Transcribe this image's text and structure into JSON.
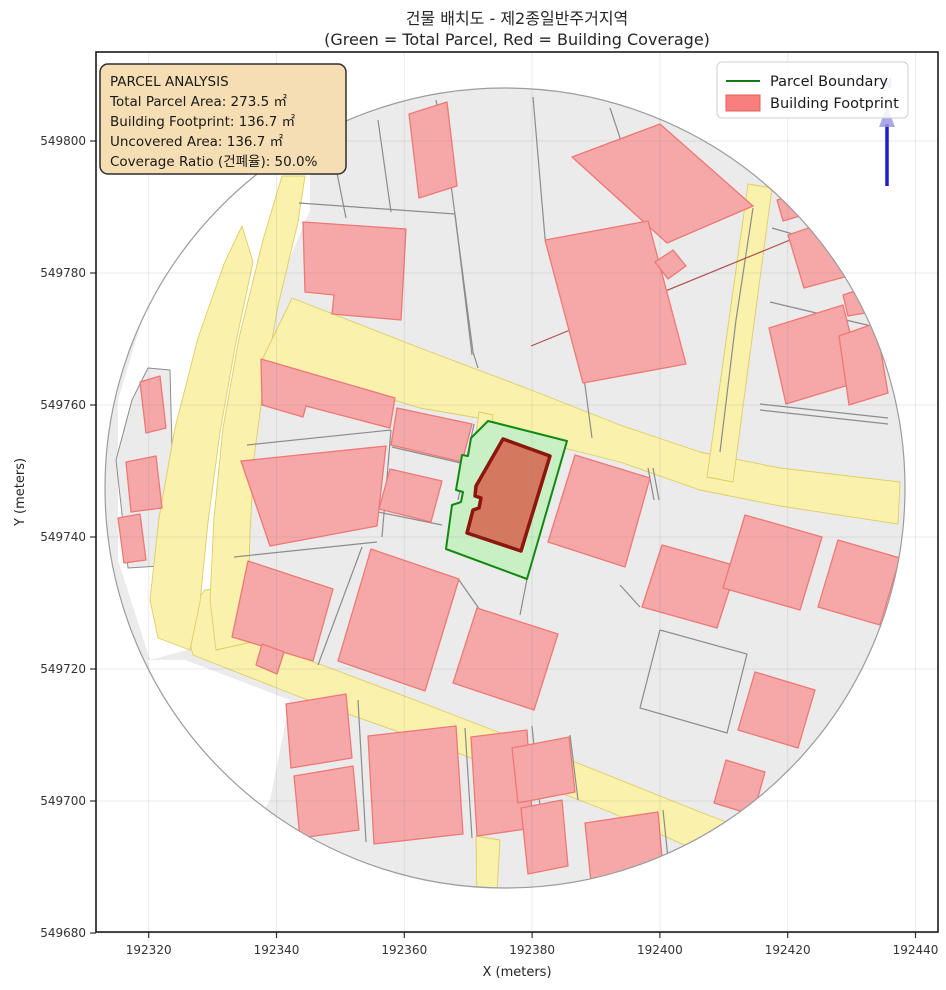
{
  "title": {
    "line1": "건물 배치도 - 제2종일반주거지역",
    "line2": "(Green = Total Parcel, Red = Building Coverage)"
  },
  "axes": {
    "xlabel": "X (meters)",
    "ylabel": "Y (meters)",
    "x_ticks": [
      192320,
      192340,
      192360,
      192380,
      192400,
      192420,
      192440
    ],
    "y_ticks": [
      549680,
      549700,
      549720,
      549740,
      549760,
      549780,
      549800
    ],
    "grid": true
  },
  "info_box": {
    "title": "PARCEL ANALYSIS",
    "line1": "Total Parcel Area: 273.5 ㎡",
    "line2": "Building Footprint: 136.7 ㎡",
    "line3": "Uncovered Area: 136.7 ㎡",
    "line4": "Coverage Ratio (건폐율): 50.0%"
  },
  "parcel_analysis": {
    "zoning": "제2종일반주거지역",
    "total_parcel_area_m2": 273.5,
    "building_footprint_m2": 136.7,
    "uncovered_area_m2": 136.7,
    "coverage_ratio_pct": 50.0
  },
  "legend": {
    "item1": "Parcel Boundary",
    "item2": "Building Footprint"
  },
  "north_arrow": {
    "label": "N"
  },
  "colors": {
    "figure_bg": "#ffffff",
    "block_gray": "#ebebeb",
    "road_fill": "#f9f1ac",
    "road_stroke": "#e0cd62",
    "building_fill": "#f5a8a7",
    "building_stroke": "#ee7876",
    "boundary_gray": "#8c8c8c",
    "circle_edge": "#9c9c9c",
    "parcel_green_fill": "#c9efc5",
    "parcel_green_stroke": "#128a12",
    "central_building_fill": "#d4795f",
    "central_building_stroke": "#8c150c",
    "infobox_fill": "#f5deb3",
    "infobox_stroke": "#2e2e2e",
    "legend_line": "#157a15",
    "legend_patch_fill": "#f97f7f",
    "legend_patch_stroke": "#e25c5a",
    "north_blue": "#1c1cd2",
    "north_lavender": "#9a9ae2",
    "grid_line": "rgba(128,128,128,0.16)",
    "red_boundary_line": "#b05050"
  },
  "map": {
    "clip_circle": {
      "cx": 505,
      "cy": 488,
      "r": 400
    },
    "white_patches": [
      [
        [
          210,
          170
        ],
        [
          310,
          170
        ],
        [
          310,
          210
        ],
        [
          260,
          330
        ],
        [
          235,
          430
        ],
        [
          220,
          530
        ],
        [
          205,
          645
        ],
        [
          150,
          660
        ],
        [
          118,
          560
        ],
        [
          118,
          400
        ],
        [
          160,
          260
        ]
      ],
      [
        [
          185,
          660
        ],
        [
          290,
          700
        ],
        [
          270,
          800
        ],
        [
          230,
          870
        ],
        [
          158,
          748
        ],
        [
          148,
          660
        ]
      ]
    ],
    "gray_patches": [
      [
        [
          148,
          368
        ],
        [
          170,
          370
        ],
        [
          175,
          565
        ],
        [
          128,
          568
        ],
        [
          116,
          460
        ],
        [
          132,
          400
        ]
      ]
    ],
    "roads": [
      [
        [
          246,
          586
        ],
        [
          254,
          640
        ],
        [
          330,
          668
        ],
        [
          420,
          702
        ],
        [
          560,
          756
        ],
        [
          700,
          812
        ],
        [
          800,
          850
        ],
        [
          786,
          890
        ],
        [
          610,
          812
        ],
        [
          450,
          750
        ],
        [
          300,
          697
        ],
        [
          193,
          655
        ],
        [
          183,
          618
        ],
        [
          205,
          590
        ]
      ],
      [
        [
          242,
          226
        ],
        [
          253,
          262
        ],
        [
          236,
          342
        ],
        [
          220,
          432
        ],
        [
          208,
          522
        ],
        [
          200,
          602
        ],
        [
          190,
          650
        ],
        [
          158,
          638
        ],
        [
          150,
          600
        ],
        [
          159,
          518
        ],
        [
          175,
          428
        ],
        [
          198,
          338
        ],
        [
          224,
          264
        ]
      ],
      [
        [
          282,
          176
        ],
        [
          305,
          176
        ],
        [
          298,
          222
        ],
        [
          278,
          306
        ],
        [
          263,
          390
        ],
        [
          254,
          458
        ],
        [
          250,
          534
        ],
        [
          248,
          600
        ],
        [
          252,
          642
        ],
        [
          216,
          650
        ],
        [
          210,
          600
        ],
        [
          214,
          518
        ],
        [
          223,
          428
        ],
        [
          239,
          338
        ],
        [
          263,
          240
        ]
      ],
      [
        [
          292,
          298
        ],
        [
          420,
          348
        ],
        [
          526,
          388
        ],
        [
          620,
          425
        ],
        [
          700,
          452
        ],
        [
          780,
          468
        ],
        [
          900,
          482
        ],
        [
          898,
          524
        ],
        [
          780,
          506
        ],
        [
          700,
          490
        ],
        [
          620,
          462
        ],
        [
          560,
          447
        ],
        [
          490,
          420
        ],
        [
          420,
          408
        ],
        [
          262,
          360
        ]
      ],
      [
        [
          748,
          184
        ],
        [
          772,
          188
        ],
        [
          733,
          482
        ],
        [
          707,
          477
        ]
      ],
      [
        [
          479,
          412
        ],
        [
          493,
          415
        ],
        [
          483,
          492
        ],
        [
          469,
          488
        ]
      ],
      [
        [
          476,
          836
        ],
        [
          500,
          840
        ],
        [
          496,
          908
        ],
        [
          477,
          903
        ]
      ]
    ],
    "boundary_lines": [
      [
        [
          332,
          148
        ],
        [
          346,
          218
        ]
      ],
      [
        [
          378,
          120
        ],
        [
          391,
          212
        ]
      ],
      [
        [
          436,
          100
        ],
        [
          452,
          192
        ],
        [
          473,
          352
        ],
        [
          478,
          368
        ]
      ],
      [
        [
          299,
          203
        ],
        [
          455,
          214
        ]
      ],
      [
        [
          455,
          214
        ],
        [
          472,
          355
        ]
      ],
      [
        [
          533,
          97
        ],
        [
          545,
          238
        ],
        [
          585,
          385
        ],
        [
          592,
          438
        ]
      ],
      [
        [
          753,
          208
        ],
        [
          736,
          320
        ],
        [
          720,
          452
        ]
      ],
      [
        [
          610,
          108
        ],
        [
          648,
          221
        ]
      ],
      [
        [
          772,
          228
        ],
        [
          890,
          262
        ]
      ],
      [
        [
          770,
          302
        ],
        [
          888,
          330
        ]
      ],
      [
        [
          760,
          404
        ],
        [
          888,
          418
        ]
      ],
      [
        [
          760,
          410
        ],
        [
          888,
          424
        ]
      ],
      [
        [
          247,
          445
        ],
        [
          391,
          430
        ]
      ],
      [
        [
          391,
          430
        ],
        [
          382,
          537
        ]
      ],
      [
        [
          234,
          557
        ],
        [
          377,
          542
        ]
      ],
      [
        [
          318,
          665
        ],
        [
          362,
          547
        ]
      ],
      [
        [
          459,
          580
        ],
        [
          480,
          610
        ]
      ],
      [
        [
          392,
          447
        ],
        [
          465,
          464
        ]
      ],
      [
        [
          378,
          512
        ],
        [
          442,
          525
        ]
      ],
      [
        [
          474,
          424
        ],
        [
          458,
          500
        ]
      ],
      [
        [
          660,
          630
        ],
        [
          747,
          654
        ],
        [
          727,
          733
        ],
        [
          640,
          708
        ],
        [
          660,
          630
        ]
      ],
      [
        [
          358,
          700
        ],
        [
          366,
          842
        ]
      ],
      [
        [
          465,
          728
        ],
        [
          472,
          838
        ]
      ],
      [
        [
          532,
          726
        ],
        [
          540,
          806
        ]
      ],
      [
        [
          570,
          735
        ],
        [
          578,
          800
        ]
      ],
      [
        [
          663,
          810
        ],
        [
          670,
          878
        ]
      ],
      [
        [
          620,
          585
        ],
        [
          640,
          607
        ]
      ],
      [
        [
          527,
          579
        ],
        [
          520,
          615
        ]
      ],
      [
        [
          648,
          468
        ],
        [
          654,
          500
        ]
      ],
      [
        [
          653,
          468
        ],
        [
          659,
          500
        ]
      ]
    ],
    "red_line": [
      [
        531,
        346
      ],
      [
        812,
        231
      ]
    ],
    "buildings": [
      [
        [
          303,
          222
        ],
        [
          406,
          229
        ],
        [
          401,
          320
        ],
        [
          332,
          314
        ],
        [
          334,
          295
        ],
        [
          305,
          292
        ]
      ],
      [
        [
          409,
          114
        ],
        [
          447,
          102
        ],
        [
          457,
          186
        ],
        [
          419,
          198
        ]
      ],
      [
        [
          572,
          157
        ],
        [
          660,
          124
        ],
        [
          753,
          206
        ],
        [
          667,
          243
        ]
      ],
      [
        [
          545,
          240
        ],
        [
          648,
          221
        ],
        [
          686,
          364
        ],
        [
          583,
          383
        ]
      ],
      [
        [
          655,
          262
        ],
        [
          673,
          250
        ],
        [
          686,
          266
        ],
        [
          668,
          279
        ]
      ],
      [
        [
          788,
          235
        ],
        [
          858,
          211
        ],
        [
          874,
          269
        ],
        [
          804,
          288
        ]
      ],
      [
        [
          769,
          328
        ],
        [
          843,
          305
        ],
        [
          862,
          381
        ],
        [
          786,
          404
        ]
      ],
      [
        [
          839,
          336
        ],
        [
          876,
          323
        ],
        [
          888,
          393
        ],
        [
          849,
          405
        ]
      ],
      [
        [
          843,
          295
        ],
        [
          867,
          287
        ],
        [
          871,
          312
        ],
        [
          848,
          316
        ]
      ],
      [
        [
          777,
          200
        ],
        [
          801,
          193
        ],
        [
          807,
          214
        ],
        [
          783,
          221
        ]
      ],
      [
        [
          140,
          382
        ],
        [
          160,
          376
        ],
        [
          166,
          428
        ],
        [
          146,
          433
        ]
      ],
      [
        [
          126,
          462
        ],
        [
          156,
          456
        ],
        [
          162,
          508
        ],
        [
          131,
          512
        ]
      ],
      [
        [
          118,
          518
        ],
        [
          140,
          514
        ],
        [
          146,
          560
        ],
        [
          124,
          563
        ]
      ],
      [
        [
          261,
          359
        ],
        [
          395,
          398
        ],
        [
          390,
          428
        ],
        [
          306,
          406
        ],
        [
          303,
          417
        ],
        [
          262,
          405
        ]
      ],
      [
        [
          241,
          461
        ],
        [
          386,
          446
        ],
        [
          377,
          526
        ],
        [
          270,
          546
        ]
      ],
      [
        [
          248,
          561
        ],
        [
          333,
          589
        ],
        [
          313,
          661
        ],
        [
          232,
          637
        ]
      ],
      [
        [
          371,
          549
        ],
        [
          459,
          579
        ],
        [
          425,
          691
        ],
        [
          338,
          661
        ]
      ],
      [
        [
          477,
          608
        ],
        [
          558,
          634
        ],
        [
          534,
          710
        ],
        [
          453,
          683
        ]
      ],
      [
        [
          397,
          408
        ],
        [
          472,
          424
        ],
        [
          462,
          462
        ],
        [
          391,
          445
        ]
      ],
      [
        [
          390,
          469
        ],
        [
          442,
          481
        ],
        [
          431,
          522
        ],
        [
          379,
          509
        ]
      ],
      [
        [
          575,
          455
        ],
        [
          650,
          478
        ],
        [
          625,
          567
        ],
        [
          548,
          542
        ]
      ],
      [
        [
          662,
          545
        ],
        [
          737,
          566
        ],
        [
          717,
          628
        ],
        [
          642,
          607
        ]
      ],
      [
        [
          745,
          515
        ],
        [
          822,
          537
        ],
        [
          800,
          610
        ],
        [
          723,
          588
        ]
      ],
      [
        [
          838,
          540
        ],
        [
          900,
          558
        ],
        [
          880,
          625
        ],
        [
          818,
          607
        ]
      ],
      [
        [
          755,
          672
        ],
        [
          815,
          690
        ],
        [
          798,
          748
        ],
        [
          738,
          730
        ]
      ],
      [
        [
          726,
          760
        ],
        [
          765,
          772
        ],
        [
          753,
          815
        ],
        [
          714,
          803
        ]
      ],
      [
        [
          262,
          644
        ],
        [
          284,
          652
        ],
        [
          277,
          674
        ],
        [
          256,
          665
        ]
      ],
      [
        [
          286,
          704
        ],
        [
          346,
          694
        ],
        [
          352,
          758
        ],
        [
          291,
          768
        ]
      ],
      [
        [
          294,
          776
        ],
        [
          353,
          766
        ],
        [
          359,
          830
        ],
        [
          300,
          838
        ]
      ],
      [
        [
          368,
          736
        ],
        [
          456,
          726
        ],
        [
          463,
          834
        ],
        [
          374,
          844
        ]
      ],
      [
        [
          471,
          737
        ],
        [
          527,
          730
        ],
        [
          533,
          828
        ],
        [
          477,
          836
        ]
      ],
      [
        [
          521,
          808
        ],
        [
          562,
          800
        ],
        [
          568,
          866
        ],
        [
          528,
          874
        ]
      ],
      [
        [
          585,
          823
        ],
        [
          658,
          812
        ],
        [
          664,
          880
        ],
        [
          592,
          892
        ]
      ],
      [
        [
          512,
          748
        ],
        [
          569,
          737
        ],
        [
          575,
          792
        ],
        [
          518,
          803
        ]
      ]
    ],
    "parcel_green": [
      [
        488,
        421
      ],
      [
        567,
        441
      ],
      [
        527,
        579
      ],
      [
        446,
        549
      ],
      [
        452,
        505
      ],
      [
        461,
        502
      ],
      [
        463,
        492
      ],
      [
        456,
        490
      ],
      [
        462,
        455
      ],
      [
        468,
        456
      ],
      [
        471,
        438
      ]
    ],
    "central_building": [
      [
        503,
        439
      ],
      [
        550,
        456
      ],
      [
        521,
        551
      ],
      [
        467,
        533
      ],
      [
        473,
        510
      ],
      [
        479,
        508
      ],
      [
        481,
        498
      ],
      [
        475,
        496
      ],
      [
        476,
        486
      ]
    ]
  }
}
